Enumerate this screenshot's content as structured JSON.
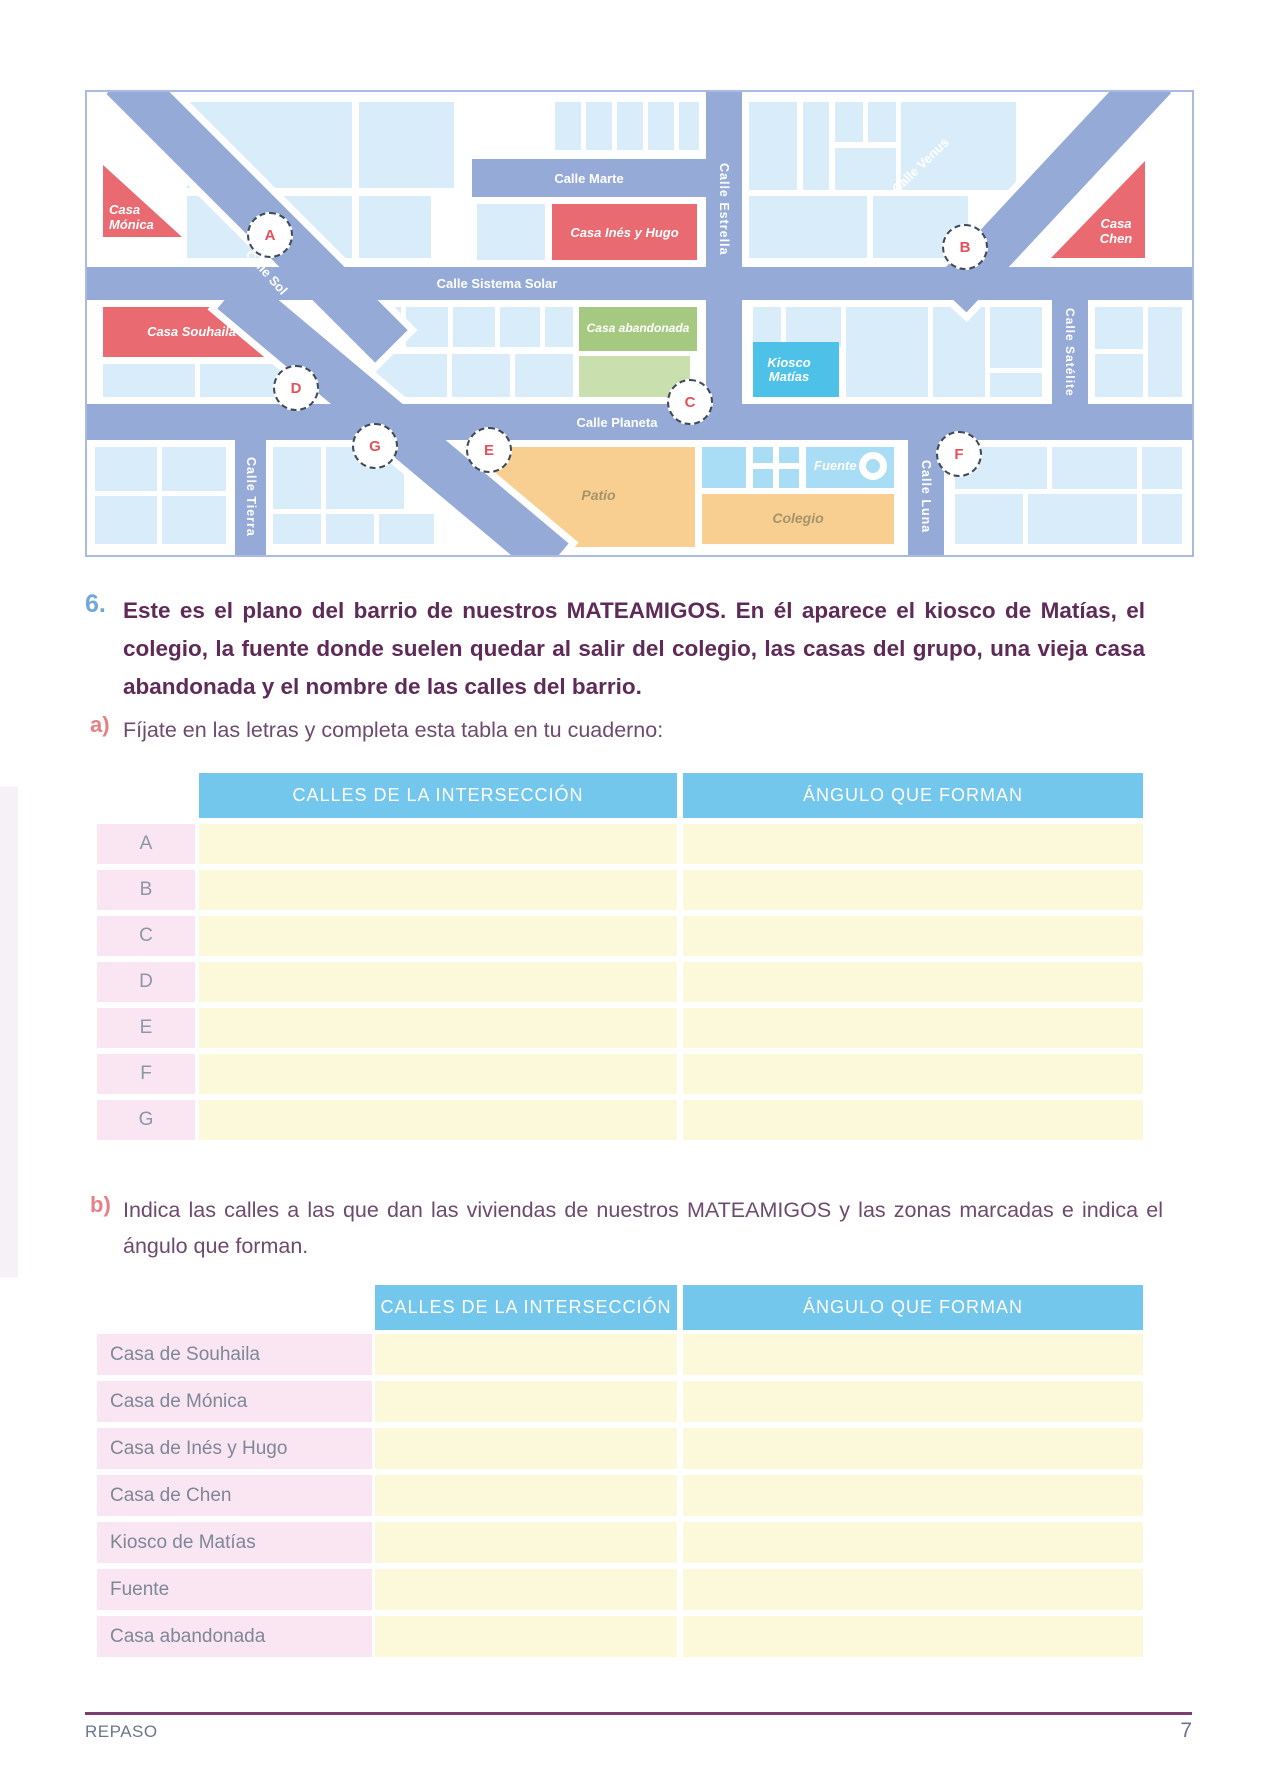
{
  "map": {
    "streets": {
      "marte": "Calle Marte",
      "sistema_solar": "Calle Sistema Solar",
      "estrella": "Calle Estrella",
      "venus": "Calle Venus",
      "sol": "Calle Sol",
      "satelite": "Calle Satélite",
      "planeta": "Calle Planeta",
      "tierra": "Calle Tierra",
      "luna": "Calle Luna"
    },
    "places": {
      "casa_monica": "Casa Mónica",
      "casa_souhaila": "Casa Souhaila",
      "casa_ines_hugo": "Casa Inés y Hugo",
      "casa_chen": "Casa Chen",
      "casa_abandonada": "Casa abandonada",
      "kiosco_matias": "Kiosco Matías",
      "fuente": "Fuente",
      "patio": "Patio",
      "colegio": "Colegio"
    },
    "markers": [
      "A",
      "B",
      "C",
      "D",
      "E",
      "F",
      "G"
    ]
  },
  "problem": {
    "number": "6.",
    "text": "Este es el plano del barrio de nuestros MATEAMIGOS. En él aparece el kiosco de Matías, el colegio, la fuente donde suelen quedar al salir del colegio, las casas del grupo, una  vieja casa abandonada y el nombre de las calles del barrio."
  },
  "part_a": {
    "label": "a)",
    "instruction": "Fíjate en las letras y completa esta tabla en tu cuaderno:",
    "table": {
      "col1": "CALLES DE LA INTERSECCIÓN",
      "col2": "ÁNGULO QUE FORMAN",
      "rows": [
        "A",
        "B",
        "C",
        "D",
        "E",
        "F",
        "G"
      ]
    }
  },
  "part_b": {
    "label": "b)",
    "instruction": "Indica las calles a las que dan las viviendas de nuestros MATEAMIGOS y las zonas marcadas e indica el ángulo que forman.",
    "table": {
      "col1": "CALLES DE LA INTERSECCIÓN",
      "col2": "ÁNGULO QUE FORMAN",
      "rows": [
        "Casa de Souhaila",
        "Casa de Mónica",
        "Casa de Inés y Hugo",
        "Casa de Chen",
        "Kiosco de Matías",
        "Fuente",
        "Casa abandonada"
      ]
    }
  },
  "footer": {
    "section": "REPASO",
    "page_number": "7"
  },
  "colors": {
    "street": "#95aad6",
    "block": "#d9ecfa",
    "house_red": "#e96a70",
    "green_dark": "#a6c981",
    "green_light": "#c9dfae",
    "kiosk_blue": "#4ec1e9",
    "fountain_blue": "#a9dcf5",
    "school_orange": "#f8cf90",
    "header_blue": "#73c7ec",
    "cell_yellow": "#fcf8da",
    "cell_pink": "#fae5f2",
    "accent_purple": "#5e2b59",
    "label_salmon": "#e87f85",
    "marker_red": "#e4515c"
  }
}
